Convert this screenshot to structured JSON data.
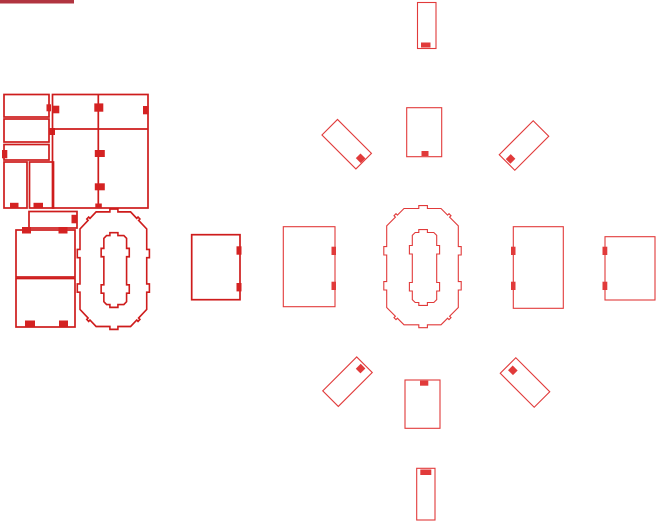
{
  "canvas": {
    "width": 666,
    "height": 525
  },
  "colors": {
    "canvas-bg": "#ffffff",
    "stroke-bold": "#ce1c1c",
    "stroke-thin": "#e13a3a",
    "tab-bold": "#d42222",
    "tab-thin": "#e13a3a",
    "titlebar": "#b13440"
  },
  "svg_shapes": [
    {
      "name": "titlebar-fragment",
      "tag": "rect",
      "interactable": false,
      "attrs": {
        "x": 0,
        "y": 0,
        "width": 74,
        "height": 3.5,
        "class": "bar-fill"
      }
    },
    {
      "name": "part-panel-a",
      "tag": "rect",
      "interactable": true,
      "attrs": {
        "x": 4,
        "y": 94.5,
        "width": 45,
        "height": 22.5,
        "class": "bold-part"
      }
    },
    {
      "name": "part-panel-a-tab",
      "tag": "rect",
      "interactable": false,
      "attrs": {
        "x": 46.5,
        "y": 104.3,
        "width": 4.5,
        "height": 7,
        "class": "tab-bold"
      }
    },
    {
      "name": "part-panel-b",
      "tag": "rect",
      "interactable": true,
      "attrs": {
        "x": 4,
        "y": 119,
        "width": 45,
        "height": 23,
        "class": "bold-part"
      }
    },
    {
      "name": "part-panel-b-tab",
      "tag": "rect",
      "interactable": false,
      "attrs": {
        "x": 48.5,
        "y": 128,
        "width": 6.5,
        "height": 7,
        "class": "tab-bold"
      }
    },
    {
      "name": "part-panel-c",
      "tag": "rect",
      "interactable": true,
      "attrs": {
        "x": 4,
        "y": 144.5,
        "width": 45,
        "height": 15.5,
        "class": "bold-part"
      }
    },
    {
      "name": "part-panel-c-tab",
      "tag": "rect",
      "interactable": false,
      "attrs": {
        "x": 2,
        "y": 150,
        "width": 5.3,
        "height": 8.3,
        "class": "tab-bold"
      }
    },
    {
      "name": "part-panel-d",
      "tag": "rect",
      "interactable": true,
      "attrs": {
        "x": 4,
        "y": 162,
        "width": 23,
        "height": 46,
        "class": "bold-part"
      }
    },
    {
      "name": "part-panel-d-tab",
      "tag": "rect",
      "interactable": false,
      "attrs": {
        "x": 10,
        "y": 202.8,
        "width": 8.5,
        "height": 5,
        "class": "tab-bold"
      }
    },
    {
      "name": "part-panel-e",
      "tag": "rect",
      "interactable": true,
      "attrs": {
        "x": 29.5,
        "y": 162,
        "width": 24,
        "height": 46,
        "class": "bold-part"
      }
    },
    {
      "name": "part-panel-e-tab",
      "tag": "rect",
      "interactable": false,
      "attrs": {
        "x": 33.5,
        "y": 202.8,
        "width": 9.5,
        "height": 5,
        "class": "tab-bold"
      }
    },
    {
      "name": "part-main-board",
      "tag": "rect",
      "interactable": true,
      "attrs": {
        "x": 52.5,
        "y": 94.5,
        "width": 95.5,
        "height": 113.5,
        "class": "bold-part"
      }
    },
    {
      "name": "part-main-board-divider-v",
      "tag": "line",
      "interactable": false,
      "attrs": {
        "x1": 98.3,
        "y1": 94.5,
        "x2": 98.3,
        "y2": 208,
        "class": "bold-part"
      }
    },
    {
      "name": "part-main-board-divider-h",
      "tag": "line",
      "interactable": false,
      "attrs": {
        "x1": 52.5,
        "y1": 129,
        "x2": 148,
        "y2": 129,
        "class": "bold-part"
      }
    },
    {
      "name": "part-main-board-tab-1",
      "tag": "rect",
      "interactable": false,
      "attrs": {
        "x": 94.3,
        "y": 103.4,
        "width": 9,
        "height": 8.3,
        "class": "tab-bold"
      }
    },
    {
      "name": "part-main-board-tab-2",
      "tag": "rect",
      "interactable": false,
      "attrs": {
        "x": 143,
        "y": 106,
        "width": 5.7,
        "height": 8.3,
        "class": "tab-bold"
      }
    },
    {
      "name": "part-main-board-tab-3",
      "tag": "rect",
      "interactable": false,
      "attrs": {
        "x": 52.8,
        "y": 105.7,
        "width": 6.5,
        "height": 7.6,
        "class": "tab-bold"
      }
    },
    {
      "name": "part-main-board-tab-4",
      "tag": "rect",
      "interactable": false,
      "attrs": {
        "x": 94.8,
        "y": 150,
        "width": 10,
        "height": 7,
        "class": "tab-bold"
      }
    },
    {
      "name": "part-main-board-tab-5",
      "tag": "rect",
      "interactable": false,
      "attrs": {
        "x": 94.8,
        "y": 183.3,
        "width": 10,
        "height": 7,
        "class": "tab-bold"
      }
    },
    {
      "name": "part-main-board-tab-6",
      "tag": "rect",
      "interactable": false,
      "attrs": {
        "x": 95.3,
        "y": 203.5,
        "width": 6.5,
        "height": 4.5,
        "class": "tab-bold"
      }
    },
    {
      "name": "part-bar",
      "tag": "rect",
      "interactable": true,
      "attrs": {
        "x": 29,
        "y": 211.5,
        "width": 48,
        "height": 16.5,
        "class": "bold-part"
      }
    },
    {
      "name": "part-bar-tab",
      "tag": "rect",
      "interactable": false,
      "attrs": {
        "x": 71.5,
        "y": 214.8,
        "width": 5,
        "height": 8.5,
        "class": "tab-bold"
      }
    },
    {
      "name": "part-square-1",
      "tag": "rect",
      "interactable": true,
      "attrs": {
        "x": 16,
        "y": 230,
        "width": 59,
        "height": 47,
        "class": "bold-part"
      }
    },
    {
      "name": "part-square-1-tab-1",
      "tag": "rect",
      "interactable": false,
      "attrs": {
        "x": 22,
        "y": 227,
        "width": 9,
        "height": 6.5,
        "class": "tab-bold"
      }
    },
    {
      "name": "part-square-1-tab-2",
      "tag": "rect",
      "interactable": false,
      "attrs": {
        "x": 58.5,
        "y": 227,
        "width": 9,
        "height": 6.5,
        "class": "tab-bold"
      }
    },
    {
      "name": "part-square-2",
      "tag": "rect",
      "interactable": true,
      "attrs": {
        "x": 16,
        "y": 278.5,
        "width": 59,
        "height": 48.5,
        "class": "bold-part"
      }
    },
    {
      "name": "part-square-2-tab-1",
      "tag": "rect",
      "interactable": false,
      "attrs": {
        "x": 25,
        "y": 320.5,
        "width": 10,
        "height": 6,
        "class": "tab-bold"
      }
    },
    {
      "name": "part-square-2-tab-2",
      "tag": "rect",
      "interactable": false,
      "attrs": {
        "x": 59,
        "y": 320.5,
        "width": 9,
        "height": 6,
        "class": "tab-bold"
      }
    },
    {
      "name": "part-octagon-left-outer",
      "tag": "path",
      "interactable": true,
      "attrs": {
        "class": "bold-part",
        "transform": "translate(80,211.7) scale(0.9316,0.98545) translate(-386.7,-208.3)",
        "d": "M 404,208.5 L 418.8,208.5 L 418.8,205.6 L 427.4,205.6 L 427.4,208.5 L 441,208.5 L 447.6,215.1 L 449,213.7 L 451,215.7 L 449.6,217.1 L 458.3,225.8 L 458.3,246.6 L 461.2,246.6 L 461.2,255 L 458.3,255 L 458.3,281.6 L 461.2,281.6 L 461.2,290 L 458.3,290 L 458.3,307.5 L 449.6,316.2 L 451,317.6 L 449,319.6 L 447.6,318.2 L 441,324.8 L 427.4,324.8 L 427.4,327.7 L 418.8,327.7 L 418.8,324.8 L 404,324.8 L 397.4,318.2 L 396,319.6 L 394,317.6 L 395.4,316.2 L 386.7,307.5 L 386.7,290 L 383.8,290 L 383.8,281.6 L 386.7,281.6 L 386.7,255 L 383.8,255 L 383.8,246.6 L 386.7,246.6 L 386.7,225.8 L 395.4,217.1 L 394,215.7 L 396,213.7 L 397.4,215.1 Z"
      }
    },
    {
      "name": "part-octagon-left-inner",
      "tag": "path",
      "interactable": true,
      "attrs": {
        "class": "bold-part",
        "transform": "translate(80,211.7) scale(0.9316,0.98545) translate(-386.7,-208.3)",
        "d": "M 415.2,232.5 L 418.8,232.5 L 418.8,229.6 L 427.4,229.6 L 427.4,232.5 L 433.8,232.5 L 436.7,235.4 L 436.7,245.5 L 439.6,245.5 L 439.6,254 L 436.7,254 L 436.7,282.5 L 439.6,282.5 L 439.6,291 L 436.7,291 L 436.7,299.6 L 433.8,302.5 L 427.4,302.5 L 427.4,305.4 L 418.8,305.4 L 418.8,302.5 L 415.2,302.5 L 412.3,299.6 L 412.3,291 L 409.4,291 L 409.4,282.5 L 412.3,282.5 L 412.3,254 L 409.4,254 L 409.4,245.5 L 412.3,245.5 L 412.3,235.4 Z"
      }
    },
    {
      "name": "part-side-panel-bold",
      "tag": "rect",
      "interactable": true,
      "attrs": {
        "x": 191.7,
        "y": 234.7,
        "width": 48.3,
        "height": 65,
        "class": "bold-part"
      }
    },
    {
      "name": "part-side-panel-bold-tab-1",
      "tag": "rect",
      "interactable": false,
      "attrs": {
        "x": 236.5,
        "y": 246.3,
        "width": 5,
        "height": 8.4,
        "class": "tab-bold"
      }
    },
    {
      "name": "part-side-panel-bold-tab-2",
      "tag": "rect",
      "interactable": false,
      "attrs": {
        "x": 236.5,
        "y": 283,
        "width": 5,
        "height": 8.4,
        "class": "tab-bold"
      }
    },
    {
      "name": "part-top-vertical",
      "tag": "rect",
      "interactable": true,
      "attrs": {
        "x": 417.5,
        "y": 2.5,
        "width": 18.5,
        "height": 46,
        "class": "thin-part"
      }
    },
    {
      "name": "part-top-vertical-tab",
      "tag": "rect",
      "interactable": false,
      "attrs": {
        "x": 421,
        "y": 42.5,
        "width": 9.5,
        "height": 5,
        "class": "tab-thin"
      }
    },
    {
      "name": "part-top-panel",
      "tag": "rect",
      "interactable": true,
      "attrs": {
        "x": 406.7,
        "y": 107.7,
        "width": 35,
        "height": 49,
        "class": "thin-part"
      }
    },
    {
      "name": "part-top-panel-tab",
      "tag": "rect",
      "interactable": false,
      "attrs": {
        "x": 421.5,
        "y": 151,
        "width": 7,
        "height": 5,
        "class": "tab-thin"
      }
    },
    {
      "name": "part-diag-nw",
      "tag": "rect",
      "interactable": true,
      "attrs": {
        "x": 322.7,
        "y": 133.2,
        "width": 48,
        "height": 22,
        "transform": "rotate(45 346.7 144.2)",
        "class": "thin-part"
      }
    },
    {
      "name": "part-diag-nw-tab",
      "tag": "rect",
      "interactable": false,
      "attrs": {
        "x": 363,
        "y": 141,
        "width": 7,
        "height": 6.6,
        "transform": "rotate(45 346.7 144.2)",
        "class": "tab-thin"
      }
    },
    {
      "name": "part-diag-ne",
      "tag": "rect",
      "interactable": true,
      "attrs": {
        "x": 500,
        "y": 134.5,
        "width": 48,
        "height": 22,
        "transform": "rotate(-45 524 145.5)",
        "class": "thin-part"
      }
    },
    {
      "name": "part-diag-ne-tab",
      "tag": "rect",
      "interactable": false,
      "attrs": {
        "x": 501.5,
        "y": 142.2,
        "width": 7,
        "height": 6.6,
        "transform": "rotate(-45 524 145.5)",
        "class": "tab-thin"
      }
    },
    {
      "name": "part-side-left",
      "tag": "rect",
      "interactable": true,
      "attrs": {
        "x": 283.3,
        "y": 226.7,
        "width": 51.7,
        "height": 80,
        "class": "thin-part"
      }
    },
    {
      "name": "part-side-left-tab-1",
      "tag": "rect",
      "interactable": false,
      "attrs": {
        "x": 331.5,
        "y": 246.7,
        "width": 4.5,
        "height": 8.3,
        "class": "tab-thin"
      }
    },
    {
      "name": "part-side-left-tab-2",
      "tag": "rect",
      "interactable": false,
      "attrs": {
        "x": 331.5,
        "y": 281.7,
        "width": 4.5,
        "height": 8.3,
        "class": "tab-thin"
      }
    },
    {
      "name": "part-octagon-center-outer",
      "tag": "path",
      "interactable": true,
      "attrs": {
        "class": "thin-part",
        "d": "M 404,208.5 L 418.8,208.5 L 418.8,205.6 L 427.4,205.6 L 427.4,208.5 L 441,208.5 L 447.6,215.1 L 449,213.7 L 451,215.7 L 449.6,217.1 L 458.3,225.8 L 458.3,246.6 L 461.2,246.6 L 461.2,255 L 458.3,255 L 458.3,281.6 L 461.2,281.6 L 461.2,290 L 458.3,290 L 458.3,307.5 L 449.6,316.2 L 451,317.6 L 449,319.6 L 447.6,318.2 L 441,324.8 L 427.4,324.8 L 427.4,327.7 L 418.8,327.7 L 418.8,324.8 L 404,324.8 L 397.4,318.2 L 396,319.6 L 394,317.6 L 395.4,316.2 L 386.7,307.5 L 386.7,290 L 383.8,290 L 383.8,281.6 L 386.7,281.6 L 386.7,255 L 383.8,255 L 383.8,246.6 L 386.7,246.6 L 386.7,225.8 L 395.4,217.1 L 394,215.7 L 396,213.7 L 397.4,215.1 Z"
      }
    },
    {
      "name": "part-octagon-center-inner",
      "tag": "path",
      "interactable": true,
      "attrs": {
        "class": "thin-part",
        "d": "M 415.2,232.5 L 418.8,232.5 L 418.8,229.6 L 427.4,229.6 L 427.4,232.5 L 433.8,232.5 L 436.7,235.4 L 436.7,245.5 L 439.6,245.5 L 439.6,254 L 436.7,254 L 436.7,282.5 L 439.6,282.5 L 439.6,291 L 436.7,291 L 436.7,299.6 L 433.8,302.5 L 427.4,302.5 L 427.4,305.4 L 418.8,305.4 L 418.8,302.5 L 415.2,302.5 L 412.3,299.6 L 412.3,291 L 409.4,291 L 409.4,282.5 L 412.3,282.5 L 412.3,254 L 409.4,254 L 409.4,245.5 L 412.3,245.5 L 412.3,235.4 Z"
      }
    },
    {
      "name": "part-side-right",
      "tag": "rect",
      "interactable": true,
      "attrs": {
        "x": 513.3,
        "y": 226.7,
        "width": 50,
        "height": 81.6,
        "class": "thin-part"
      }
    },
    {
      "name": "part-side-right-tab-1",
      "tag": "rect",
      "interactable": false,
      "attrs": {
        "x": 511,
        "y": 246.7,
        "width": 4.5,
        "height": 8.3,
        "class": "tab-thin"
      }
    },
    {
      "name": "part-side-right-tab-2",
      "tag": "rect",
      "interactable": false,
      "attrs": {
        "x": 511,
        "y": 281.7,
        "width": 4.5,
        "height": 8.3,
        "class": "tab-thin"
      }
    },
    {
      "name": "part-side-far-right",
      "tag": "rect",
      "interactable": true,
      "attrs": {
        "x": 605,
        "y": 236.7,
        "width": 50,
        "height": 63.3,
        "class": "thin-part"
      }
    },
    {
      "name": "part-side-far-right-tab-1",
      "tag": "rect",
      "interactable": false,
      "attrs": {
        "x": 602.5,
        "y": 246.7,
        "width": 4.8,
        "height": 8.3,
        "class": "tab-thin"
      }
    },
    {
      "name": "part-side-far-right-tab-2",
      "tag": "rect",
      "interactable": false,
      "attrs": {
        "x": 602.5,
        "y": 281.7,
        "width": 4.8,
        "height": 8.3,
        "class": "tab-thin"
      }
    },
    {
      "name": "part-diag-sw",
      "tag": "rect",
      "interactable": true,
      "attrs": {
        "x": 323.5,
        "y": 370.7,
        "width": 48,
        "height": 22,
        "transform": "rotate(-45 347.5 381.7)",
        "class": "thin-part"
      }
    },
    {
      "name": "part-diag-sw-tab",
      "tag": "rect",
      "interactable": false,
      "attrs": {
        "x": 362.5,
        "y": 378.4,
        "width": 7,
        "height": 6.6,
        "transform": "rotate(-45 347.5 381.7)",
        "class": "tab-thin"
      }
    },
    {
      "name": "part-diag-se",
      "tag": "rect",
      "interactable": true,
      "attrs": {
        "x": 501,
        "y": 371.5,
        "width": 48,
        "height": 22,
        "transform": "rotate(45 525 382.5)",
        "class": "thin-part"
      }
    },
    {
      "name": "part-diag-se-tab",
      "tag": "rect",
      "interactable": false,
      "attrs": {
        "x": 504.3,
        "y": 379.2,
        "width": 7,
        "height": 6.6,
        "transform": "rotate(45 525 382.5)",
        "class": "tab-thin"
      }
    },
    {
      "name": "part-bottom-panel",
      "tag": "rect",
      "interactable": true,
      "attrs": {
        "x": 405,
        "y": 380,
        "width": 35,
        "height": 48.3,
        "class": "thin-part"
      }
    },
    {
      "name": "part-bottom-panel-tab",
      "tag": "rect",
      "interactable": false,
      "attrs": {
        "x": 420,
        "y": 380.7,
        "width": 8.3,
        "height": 5,
        "class": "tab-thin"
      }
    },
    {
      "name": "part-bottom-vertical",
      "tag": "rect",
      "interactable": true,
      "attrs": {
        "x": 416.7,
        "y": 468.3,
        "width": 18.3,
        "height": 51.7,
        "class": "thin-part"
      }
    },
    {
      "name": "part-bottom-vertical-tab",
      "tag": "rect",
      "interactable": false,
      "attrs": {
        "x": 420.3,
        "y": 469.5,
        "width": 11,
        "height": 5.5,
        "class": "tab-thin"
      }
    }
  ]
}
